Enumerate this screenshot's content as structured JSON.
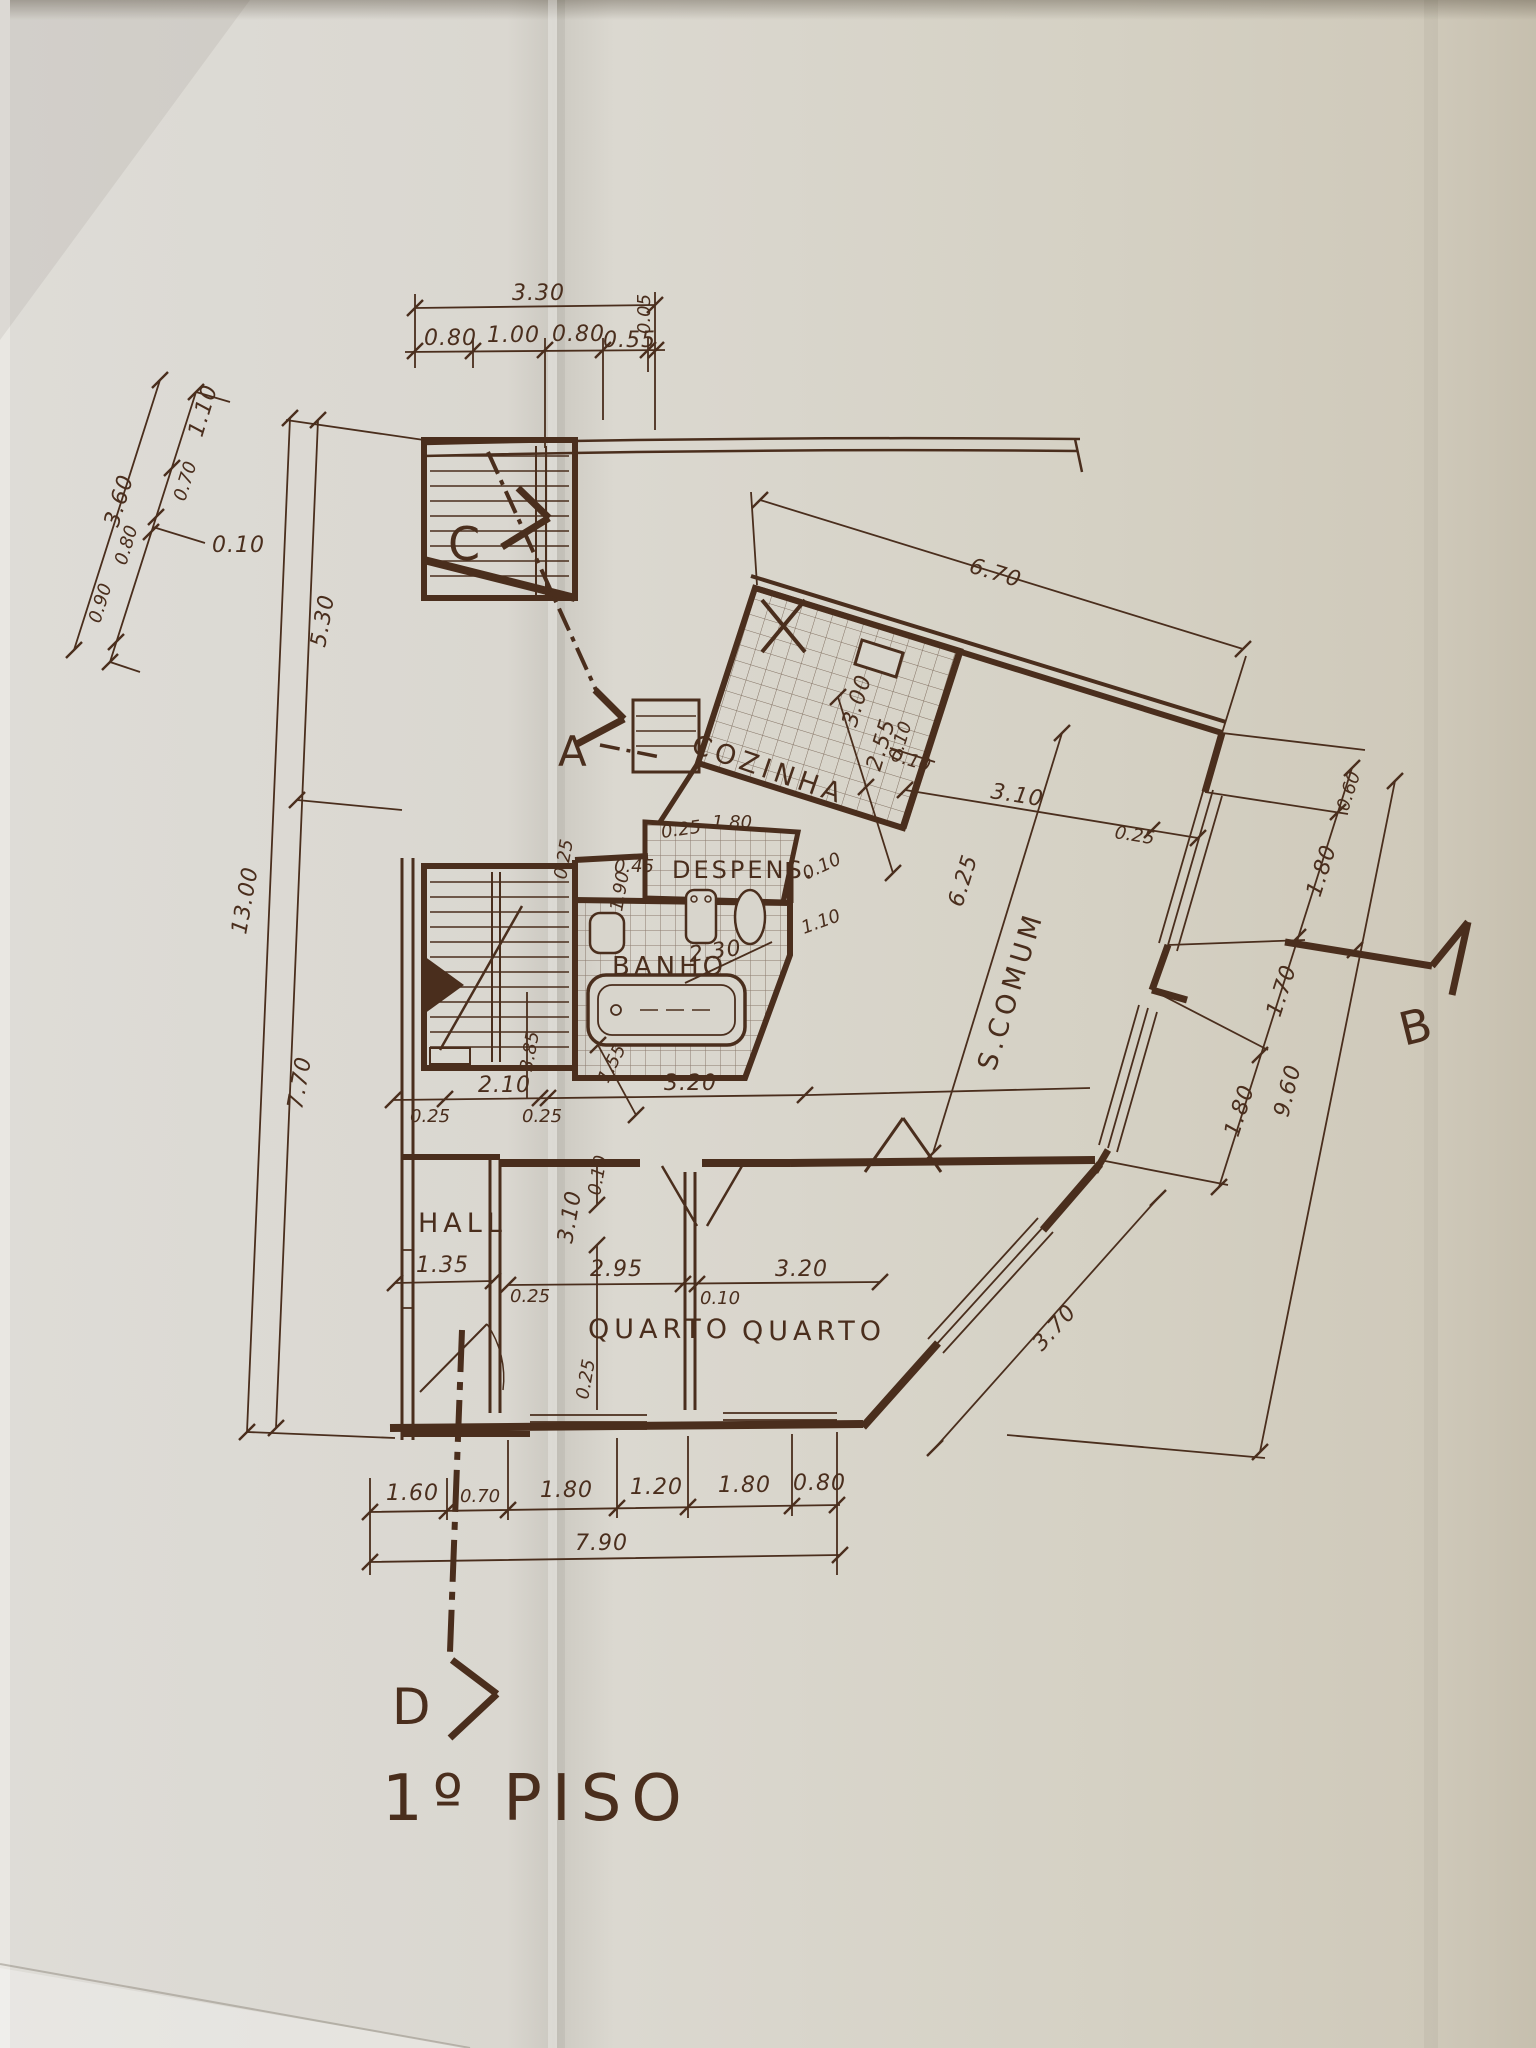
{
  "title": "1º PISO",
  "colors": {
    "ink": "#4a2e1d",
    "paper": "#d8d5cc",
    "paper_right": "#cfc9ba",
    "crease": "#c6c2b7"
  },
  "markers": {
    "a": "A",
    "b": "B",
    "c": "C",
    "d": "D"
  },
  "rooms": {
    "cozinha": "COZINHA",
    "despensa": "DESPENS.",
    "banho": "BANHO",
    "hall": "HALL",
    "quarto1": "QUARTO",
    "quarto2": "QUARTO",
    "comum_s": "S.",
    "comum": "COMUM"
  },
  "dims": {
    "top_total": "3.30",
    "top_1": "0.80",
    "top_2": "1.00",
    "top_3": "0.80",
    "top_4": "0.55",
    "top_5": "0.05",
    "ul_total": "3.60",
    "ul_1": "1.10",
    "ul_2": "0.70",
    "ul_offset": "0.10",
    "ul_3": "0.80",
    "ul_4": "0.90",
    "left_total": "13.00",
    "left_upper": "5.30",
    "left_lower": "7.70",
    "wing_width": "6.70",
    "kit_w": "3.00",
    "kit_d": "2.55",
    "kit_wall": "0.10",
    "com_wall": "0.10",
    "com_310": "3.10",
    "com_025": "0.25",
    "com_625": "6.25",
    "desp_025": "0.25",
    "desp_045": "0.45",
    "desp_190": "1.90",
    "desp_010": "0.10",
    "desp_110": "1.10",
    "kit_180": "1.80",
    "kit_025": "0.25",
    "banho_230": "2.30",
    "right_060": "0.60",
    "right_180a": "1.80",
    "right_170": "1.70",
    "right_180b": "1.80",
    "right_total": "9.60",
    "q2_370": "3.70",
    "mid_025a": "0.25",
    "mid_210": "2.10",
    "mid_025b": "0.25",
    "mid_155": "1.55",
    "mid_320": "3.20",
    "mid_385": "3.85",
    "bed_010a": "0.10",
    "hall_135": "1.35",
    "bed_025a": "0.25",
    "bed_310": "3.10",
    "bed_295": "2.95",
    "bed_wall_010": "0.10",
    "bed_320": "3.20",
    "bed_025b": "0.25",
    "bot_160": "1.60",
    "bot_070": "0.70",
    "bot_180a": "1.80",
    "bot_120": "1.20",
    "bot_180b": "1.80",
    "bot_080": "0.80",
    "bot_total": "7.90"
  }
}
